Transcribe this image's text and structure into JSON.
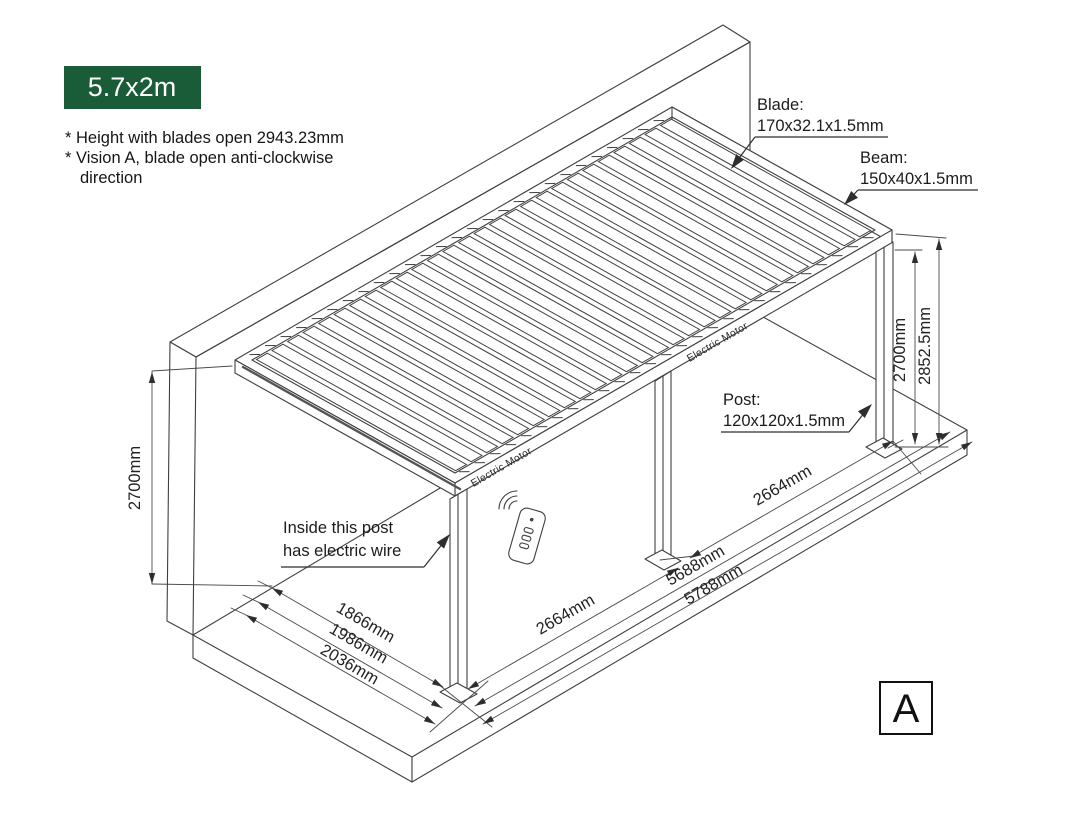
{
  "badge": {
    "label": "5.7x2m",
    "bg": "#1a5c38"
  },
  "notes": {
    "line1": "* Height with blades open 2943.23mm",
    "line2": "* Vision A, blade open anti-clockwise",
    "line3": "direction"
  },
  "callouts": {
    "blade": {
      "title": "Blade:",
      "size": "170x32.1x1.5mm"
    },
    "beam": {
      "title": "Beam:",
      "size": "150x40x1.5mm"
    },
    "post": {
      "title": "Post:",
      "size": "120x120x1.5mm"
    },
    "wire": {
      "line1": "Inside this post",
      "line2": "has electric wire"
    },
    "motor": "Electric Motor"
  },
  "dimensions": {
    "left_height": "2700mm",
    "post_height": "2700mm",
    "total_height": "2852.5mm",
    "bay_left": "2664mm",
    "bay_right": "2664mm",
    "span_inner": "5688mm",
    "span_outer": "5788mm",
    "depth_inner": "1866mm",
    "depth_mid": "1986mm",
    "depth_outer": "2036mm"
  },
  "view_label": "A",
  "diagram": {
    "blade_count": 27,
    "accent": "#1a5c38",
    "line_color": "#3f3f3f"
  }
}
